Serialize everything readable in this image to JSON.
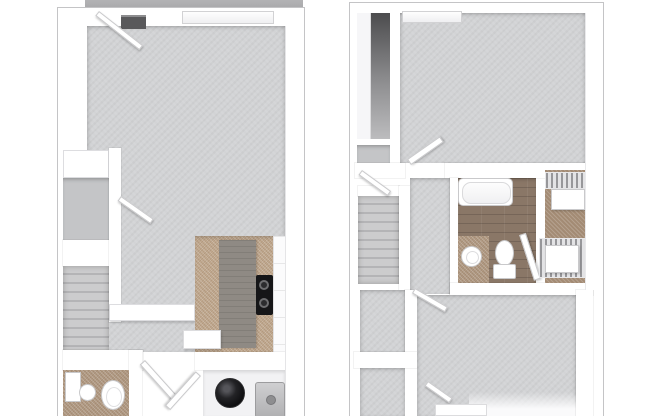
{
  "image": {
    "description": "3D top-down floor plan of a two-level townhouse apartment, two panels side by side on white background",
    "background": "#ffffff"
  },
  "colors": {
    "outline": "#c4c4c6",
    "slab": "#a8a8aa",
    "carpet": "#d2d3d5",
    "carpet_dark": "#c4c5c7",
    "tile_kitchen": "#c2aa90",
    "tile_bath": "#b19a83",
    "wood": "#8a7767",
    "counter": "#8f8a84",
    "cabinet": "#fbfbfc",
    "appliance_black": "#161618",
    "appliance_gray": "#b0b0b2",
    "vent": "#59595b",
    "fixture_edge": "#c9c9cb",
    "stair_light": "#cccccd",
    "stair_dark": "#b4b4b6",
    "wire_shelf": "#97979a",
    "wardrobe_dark": "#4c4c4e"
  },
  "panels": {
    "left": {
      "label": "Lower level floor plan: living room with carpet, entry door and window at top, coat closet and staircase on left, kitchen with tan tile, gray island counter, black cooktop and white cabinets at lower right, half bathroom with toilet and sink at lower left, utility closet with round water heater and washer at bottom",
      "rooms": [
        "living-room",
        "kitchen",
        "half-bathroom",
        "utility-closet",
        "staircase",
        "entry-closet"
      ],
      "fixtures": [
        "patio-slab",
        "entry-door",
        "wall-vent",
        "window",
        "closet-shelf",
        "staircase",
        "interior-door",
        "half-wall-ledge",
        "kitchen-island-counter",
        "stove-cooktop",
        "kitchen-cabinets",
        "kitchen-counter",
        "bathroom-vanity",
        "pedestal-sink",
        "toilet",
        "swing-door",
        "swing-door",
        "water-heater",
        "washer"
      ]
    },
    "right": {
      "label": "Upper level floor plan: large bedroom with carpet and window at top, mirrored wardrobe closet top left, staircase and hallway mid left, bathroom with bathtub, pedestal sink and toilet on wood floor, walk-in closet with wire shelving and dressers on right, second bedroom at bottom",
      "rooms": [
        "bedroom-1",
        "hallway",
        "bathroom",
        "walk-in-closet",
        "bedroom-2",
        "staircase"
      ],
      "fixtures": [
        "wardrobe-closet",
        "closet-niche",
        "window",
        "bedroom-door",
        "staircase",
        "hall-door",
        "bathtub",
        "pedestal-sink",
        "toilet",
        "bathroom-door",
        "wire-shelf",
        "dresser",
        "wire-shelf",
        "dresser",
        "bedroom-door",
        "window-sill"
      ]
    }
  }
}
